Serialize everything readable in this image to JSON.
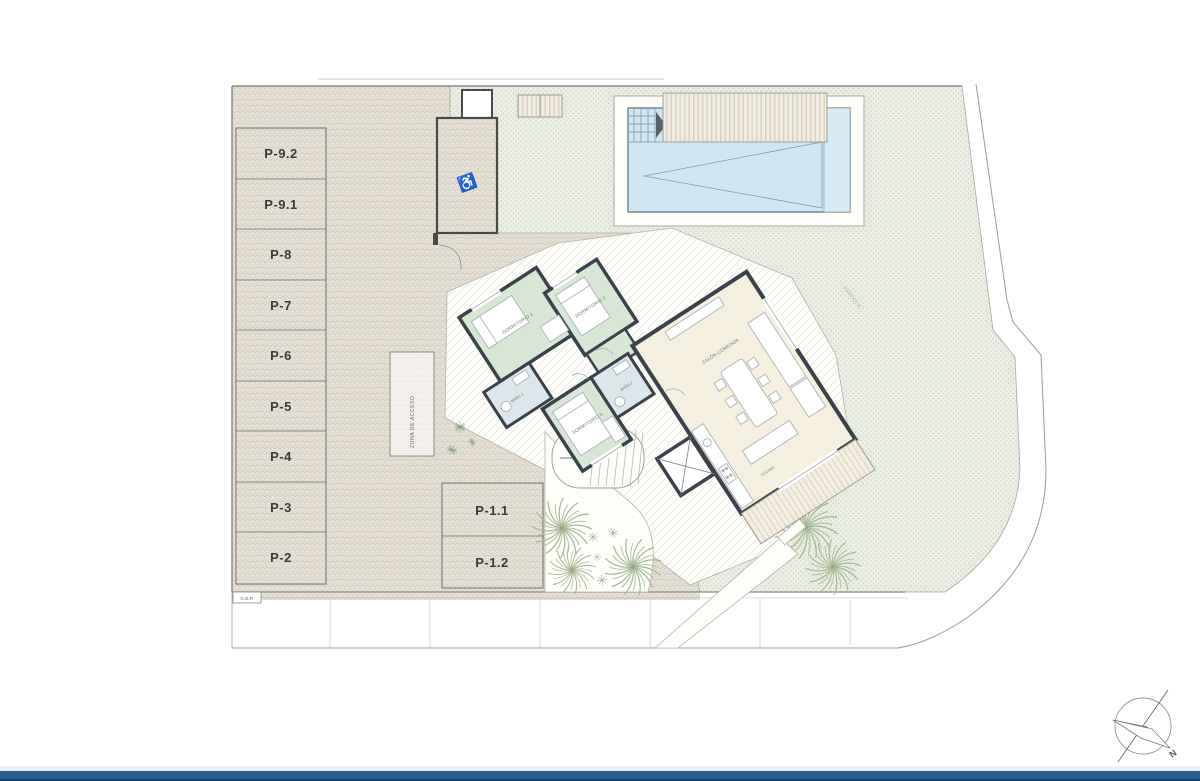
{
  "plan": {
    "parking": {
      "row_stalls": [
        "P-9.2",
        "P-9.1",
        "P-8",
        "P-7",
        "P-6",
        "P-5",
        "P-4",
        "P-3",
        "P-2"
      ],
      "island_stalls": [
        "P-1.1",
        "P-1.2"
      ],
      "accessible_icon": "wheelchair-icon"
    },
    "labels": {
      "utility_box": "C.G.P.",
      "access_zone": "ZONA DE ACCESO",
      "lawn_note": "PARCELA"
    },
    "house": {
      "bedroom1": "DORMITORIO 1",
      "bedroom2": "DORMITORIO 2",
      "bedroom3": "DORMITORIO 3",
      "bath1": "BAÑO 1",
      "bath2": "BAÑO 2",
      "living": "SALÓN-COMEDOR",
      "kitchen": "COCINA"
    },
    "compass": {
      "north": "N"
    },
    "colors": {
      "paving": "#e8e3da",
      "paving_stroke": "#cfc7b8",
      "lawn": "#ebeee4",
      "lawn_dot": "#b9c3ab",
      "pool_water": "#cfe6f3",
      "wall": "#39424b",
      "bedroom_fill": "#d8e7d5",
      "bath_fill": "#dde6ea",
      "living_fill": "#f4efdf",
      "palm": "#a3b892",
      "footer_bar": "#2b5f8c"
    }
  }
}
